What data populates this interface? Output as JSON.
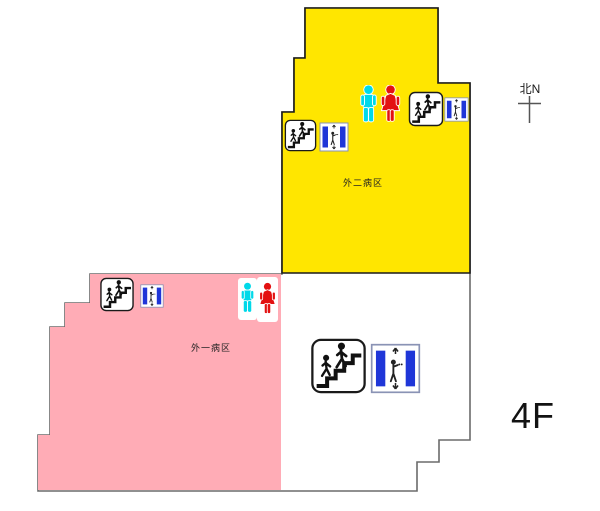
{
  "floorplan": {
    "floor_label": "4F",
    "compass_label": "北N",
    "wards": [
      {
        "name": "ward-2",
        "label": "外二病区",
        "fill": "#ffe600"
      },
      {
        "name": "ward-1",
        "label": "外一病区",
        "fill": "#ffacb6"
      }
    ],
    "colors": {
      "outline": "#6b6b6b",
      "ward2_fill": "#ffe600",
      "ward1_fill": "#ffacb6",
      "elevator_blue": "#1f36d8",
      "male_toilet_cyan": "#00d9e9",
      "female_toilet_red": "#e31111",
      "icon_ink": "#111111"
    },
    "icons": [
      {
        "name": "stairs-icon",
        "meaning": "stairs"
      },
      {
        "name": "elevator-icon",
        "meaning": "elevator"
      },
      {
        "name": "male-toilet-icon",
        "meaning": "male toilet"
      },
      {
        "name": "female-toilet-icon",
        "meaning": "female toilet"
      },
      {
        "name": "north-cross-icon",
        "meaning": "north compass"
      }
    ]
  }
}
